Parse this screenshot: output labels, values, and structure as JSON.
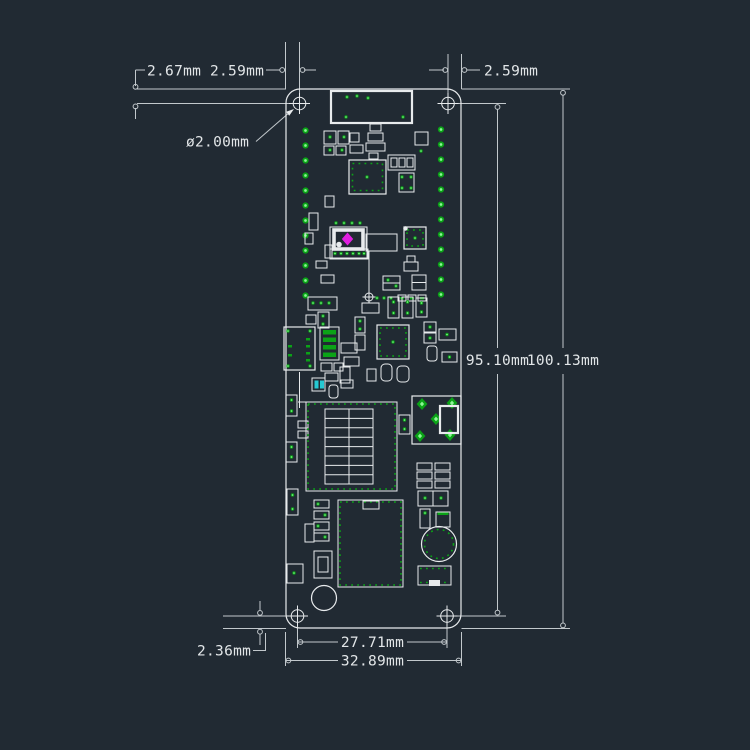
{
  "drawing": {
    "kind": "pcb-mechanical-dimension-drawing",
    "units": "mm"
  },
  "dimensions": {
    "top_left_height": "2.67mm",
    "top_left_offset": "2.59mm",
    "top_right_offset": "2.59mm",
    "hole_diameter": "ø2.00mm",
    "holes_height": "95.10mm",
    "board_height": "100.13mm",
    "bottom_offset": "2.36mm",
    "holes_width": "27.71mm",
    "board_width": "32.89mm"
  },
  "colors": {
    "background": "#212a33",
    "line": "#c2c8cc",
    "text": "#e2e6e8",
    "silkscreen": "#e8ebed",
    "pad": "#0ba317",
    "pad_bright": "#8df596",
    "marker_magenta": "#e01fe0",
    "marker_cyan": "#25c8d2"
  }
}
